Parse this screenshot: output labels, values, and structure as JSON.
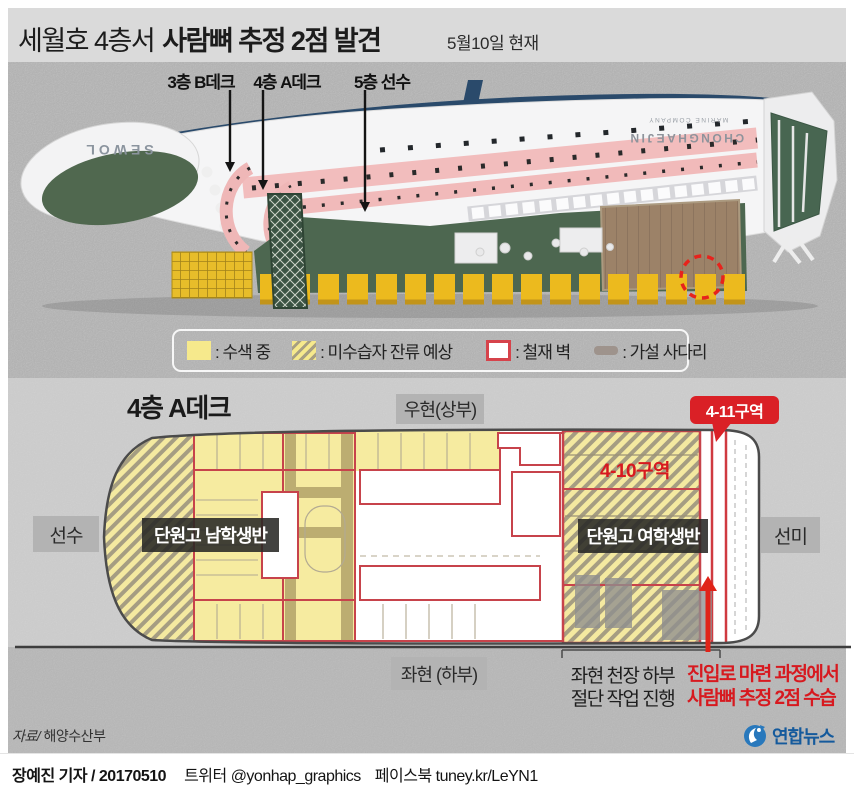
{
  "header": {
    "title_regular": "세월호 4층서",
    "title_bold": "사람뼈 추정 2점 발견",
    "date_note": "5월10일 현재"
  },
  "ship": {
    "labels": [
      {
        "text": "3층 B데크"
      },
      {
        "text": "4층 A데크"
      },
      {
        "text": "5층 선수"
      }
    ],
    "hull_name": "SEWOL",
    "company_line1": "CHONGHAEJIN",
    "company_line2": "MARINE COMPANY"
  },
  "legend": {
    "items": [
      {
        "label": ": 수색 중",
        "swatch": "search-yellow"
      },
      {
        "label": ": 미수습자 잔류 예상",
        "swatch": "hatched-yellow"
      },
      {
        "label": ": 철재 벽",
        "swatch": "red-outline"
      },
      {
        "label": ": 가설 사다리",
        "swatch": "gray-ladder"
      }
    ]
  },
  "deck_plan": {
    "title": "4층 A데크",
    "starboard_label": "우현(상부)",
    "port_label": "좌현 (하부)",
    "bow_label": "선수",
    "stern_label": "선미",
    "zone_410": "4-10구역",
    "zone_411": "4-11구역",
    "boys_class": "단원고 남학생반",
    "girls_class": "단원고 여학생반"
  },
  "annotations": {
    "cutting_line1": "좌현 천장 하부",
    "cutting_line2": "절단 작업 진행",
    "bones_line1": "진입로 마련 과정에서",
    "bones_line2": "사람뼈 추정 2점 수습"
  },
  "footer": {
    "source_label": "자료/",
    "source_value": " 해양수산부",
    "agency": "연합뉴스",
    "reporter": "장예진 기자",
    "slash": " / ",
    "date": "20170510",
    "twitter_label": "트위터 ",
    "twitter_handle": "@yonhap_graphics",
    "facebook_label": "페이스북 ",
    "facebook_url": "tuney.kr/LeYN1"
  },
  "colors": {
    "accent_red": "#d7191f",
    "badge_red": "#da2026",
    "wall_red": "#c7434b",
    "search_yellow": "#f6e98c",
    "ladder_gray": "#9e938c",
    "label_gray": "#b3b3b3",
    "dark_label": "#282825",
    "yonhap_blue": "#155a9c"
  }
}
